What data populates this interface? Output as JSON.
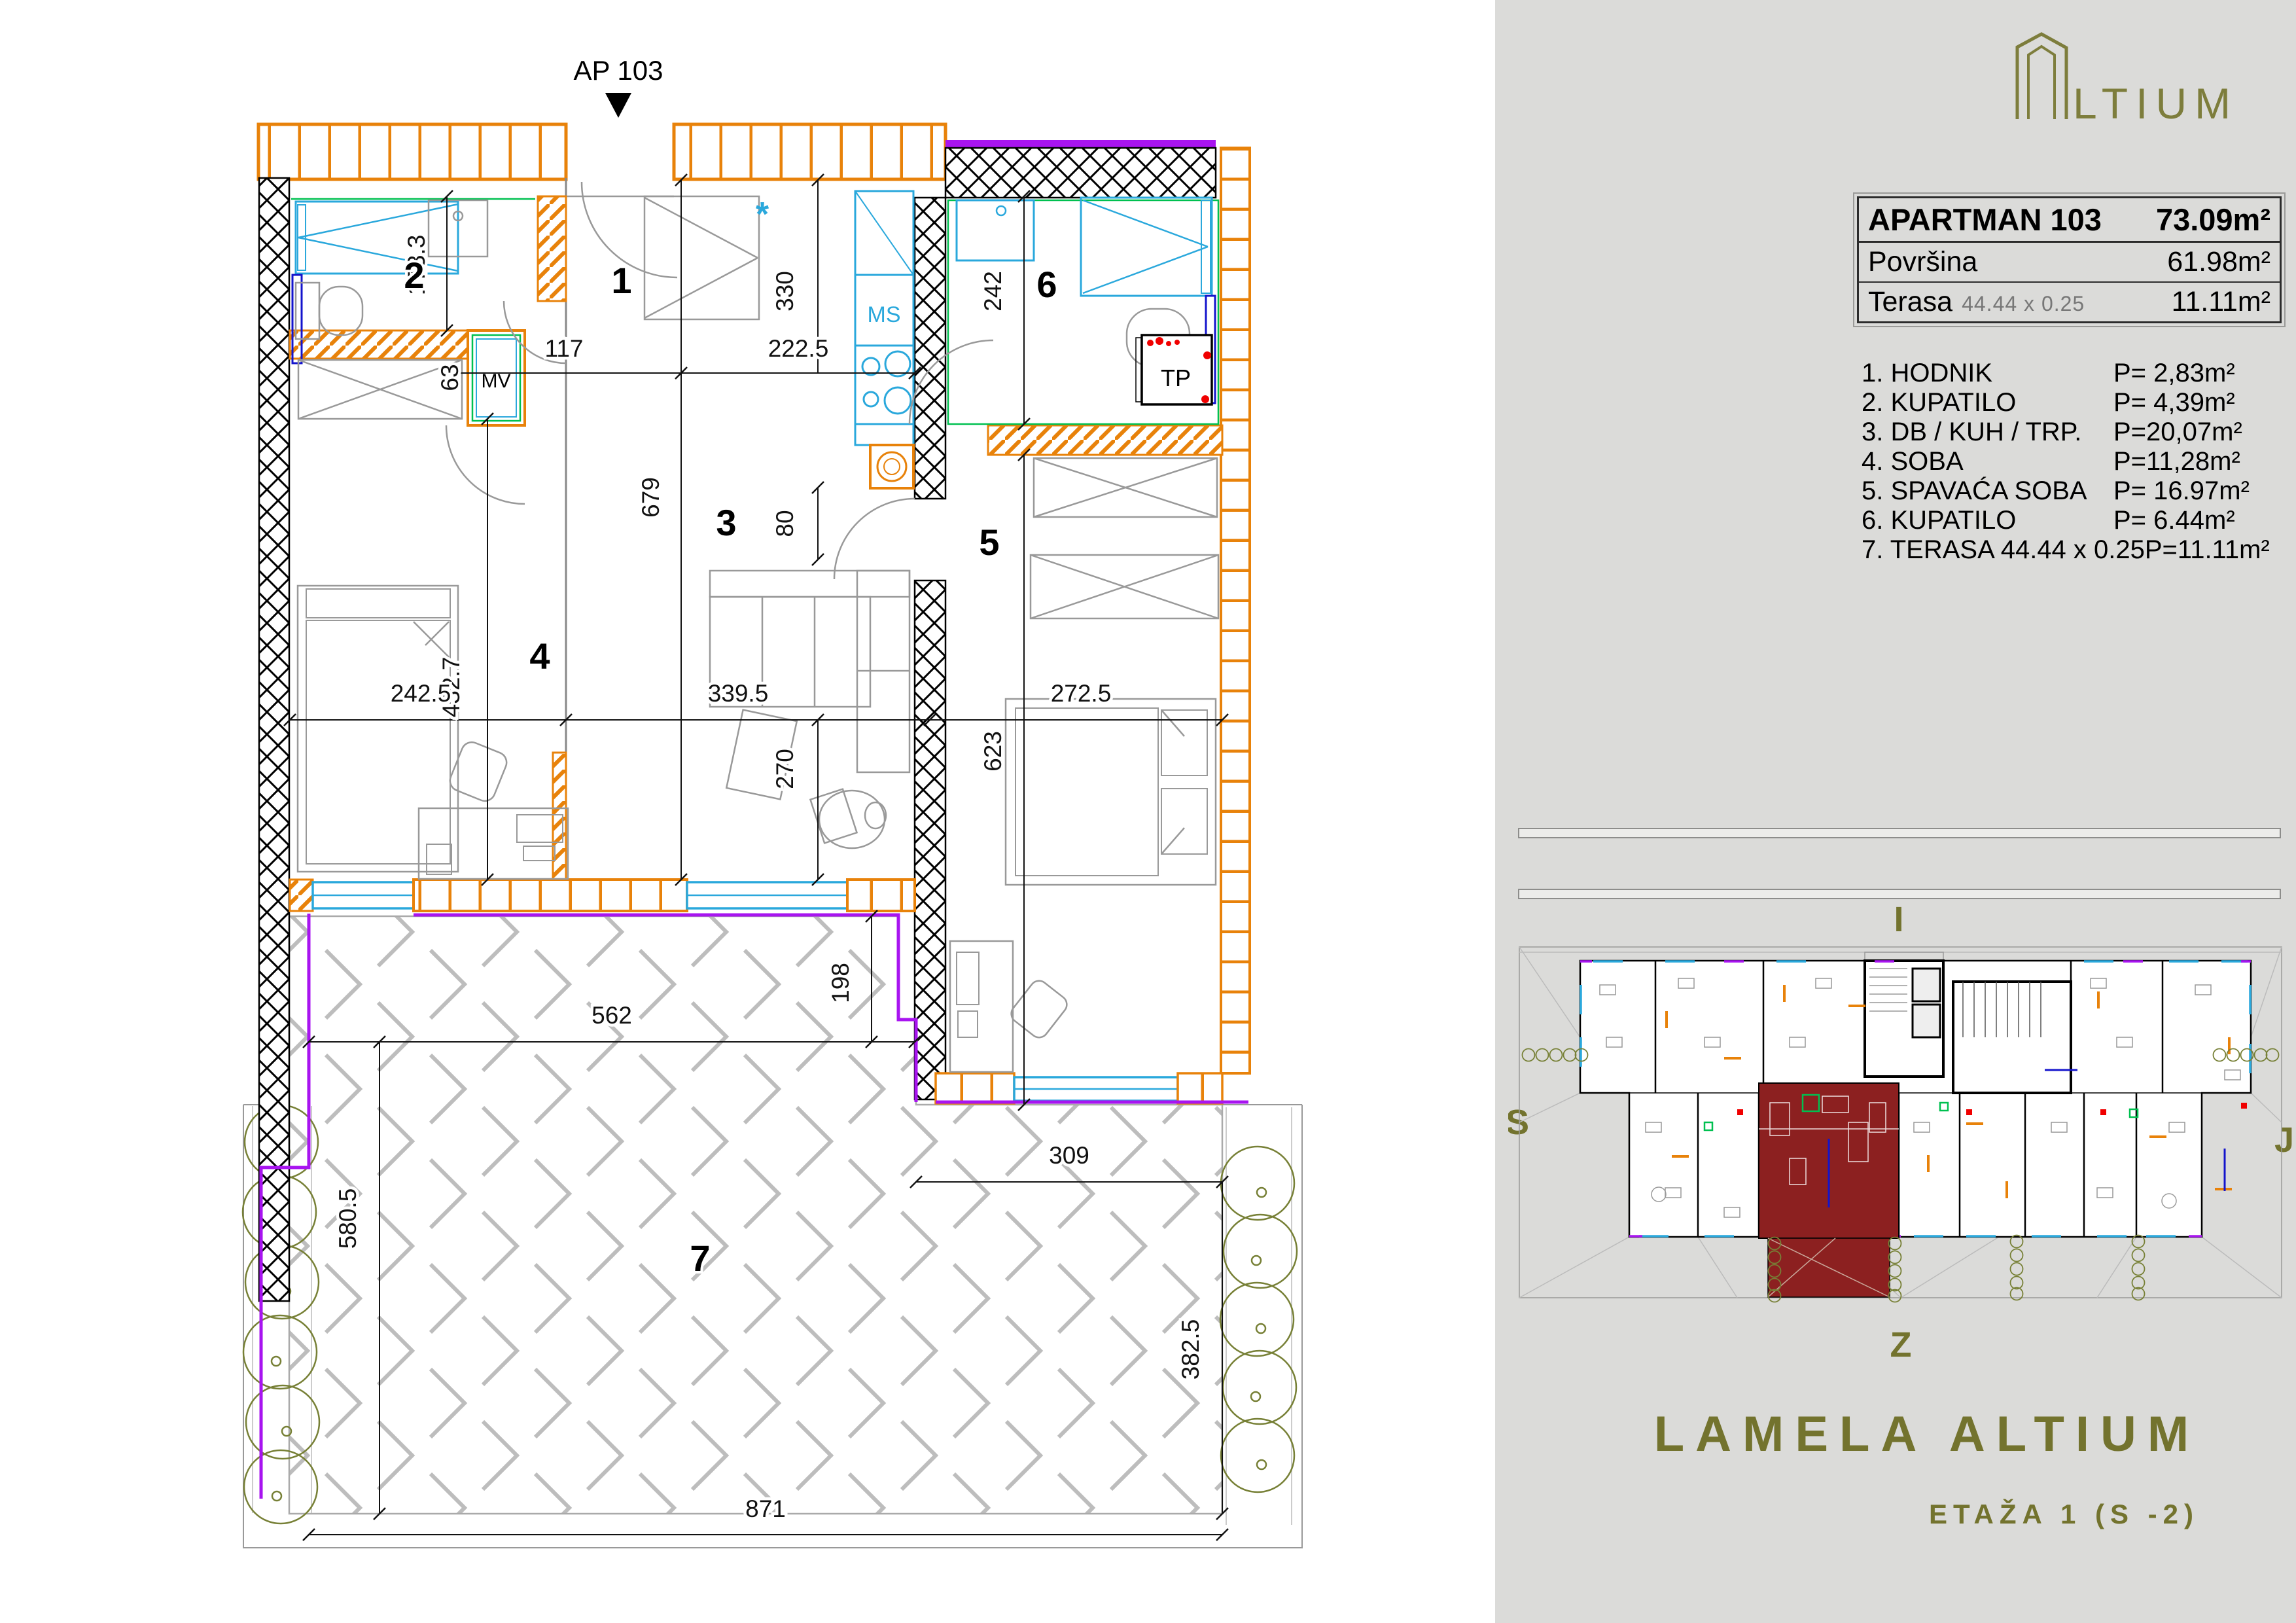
{
  "plan": {
    "entrance_label": "AP 103",
    "rooms": {
      "r1": "1",
      "r2": "2",
      "r3": "3",
      "r4": "4",
      "r5": "5",
      "r6": "6",
      "r7": "7"
    },
    "fixtures": {
      "mv": "MV",
      "ms": "MS",
      "tp": "TP",
      "star": "*"
    },
    "dims": [
      {
        "v": "173.3"
      },
      {
        "v": "63"
      },
      {
        "v": "117"
      },
      {
        "v": "222.5"
      },
      {
        "v": "330"
      },
      {
        "v": "679"
      },
      {
        "v": "80"
      },
      {
        "v": "432.7"
      },
      {
        "v": "242"
      },
      {
        "v": "242.5"
      },
      {
        "v": "339.5"
      },
      {
        "v": "272.5"
      },
      {
        "v": "270"
      },
      {
        "v": "623"
      },
      {
        "v": "562"
      },
      {
        "v": "198"
      },
      {
        "v": "309"
      },
      {
        "v": "580.5"
      },
      {
        "v": "382.5"
      },
      {
        "v": "871"
      }
    ]
  },
  "panel": {
    "logo_text": "LTIUM",
    "info": {
      "title": "APARTMAN 103",
      "title_area": "73.09m²",
      "row1_label": "Površina",
      "row1_value": "61.98m²",
      "row2_label": "Terasa",
      "row2_note": "44.44 x 0.25",
      "row2_value": "11.11m²"
    },
    "room_list": [
      {
        "name": "1. HODNIK",
        "area": "P= 2,83m²"
      },
      {
        "name": "2. KUPATILO",
        "area": "P= 4,39m²"
      },
      {
        "name": "3. DB / KUH / TRP.",
        "area": "P=20,07m²"
      },
      {
        "name": "4. SOBA",
        "area": "P=11,28m²"
      },
      {
        "name": "5. SPAVAĆA SOBA",
        "area": "P= 16.97m²"
      },
      {
        "name": "6. KUPATILO",
        "area": "P= 6.44m²"
      },
      {
        "name": "7. TERASA 44.44 x 0.25",
        "area": "P=11.11m²"
      }
    ],
    "compass": {
      "top": "I",
      "left": "S",
      "right": "J",
      "bottom": "Z"
    },
    "footer": {
      "title": "LAMELA ALTIUM",
      "subtitle": "ETAŽA 1 (S -2)"
    },
    "colors": {
      "accent_olive": "#73732e",
      "highlight_red": "#8c2020",
      "wall_orange": "#e8820a",
      "window_cyan": "#2aa8dc",
      "terrace_purple": "#a814f0"
    }
  }
}
